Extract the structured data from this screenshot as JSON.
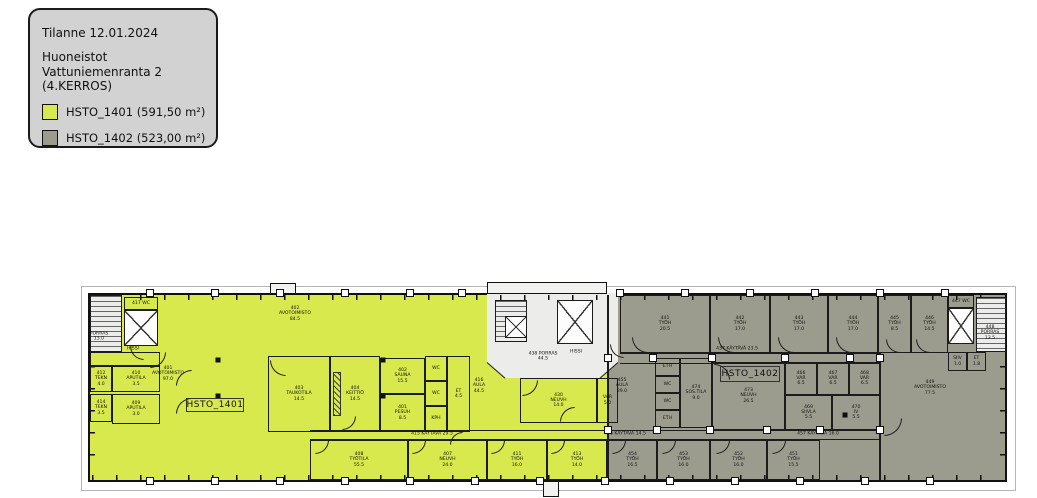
{
  "legend": {
    "status_line": "Tilanne 12.01.2024",
    "title_lines": [
      "Huoneistot",
      "Vattuniemenranta 2",
      "(4.KERROS)"
    ],
    "items": [
      {
        "id": "HSTO_1401",
        "label": "HSTO_1401 (591,50 m²)",
        "color": "#d7e94c"
      },
      {
        "id": "HSTO_1402",
        "label": "HSTO_1402 (523,00 m²)",
        "color": "#9c9c8e"
      }
    ]
  },
  "colors": {
    "apartment_1401": "#d7e94c",
    "apartment_1402": "#9c9c8e",
    "common_area": "#ececea",
    "wall": "#1c1c1c",
    "legend_bg": "#d2d2d2"
  },
  "plan": {
    "apartment_boxes": [
      {
        "text": "HSTO_1401",
        "x": 186,
        "y": 398,
        "w": 58,
        "h": 14
      },
      {
        "text": "HSTO_1402",
        "x": 720,
        "y": 366,
        "w": 60,
        "h": 16
      }
    ],
    "rooms": [
      {
        "x": 90,
        "y": 295,
        "w": 32,
        "h": 57,
        "fill": "stairs",
        "lines": []
      },
      {
        "x": 124,
        "y": 297,
        "w": 34,
        "h": 13,
        "fill": "yellow",
        "lines": [
          "417 WC"
        ]
      },
      {
        "x": 124,
        "y": 310,
        "w": 34,
        "h": 36,
        "fill": "elevator",
        "lines": []
      },
      {
        "x": 90,
        "y": 352,
        "w": 70,
        "h": 14,
        "fill": "yellow",
        "lines": []
      },
      {
        "x": 90,
        "y": 366,
        "w": 22,
        "h": 26,
        "fill": "yellow",
        "lines": [
          "412",
          "TEKN",
          "4.0"
        ]
      },
      {
        "x": 112,
        "y": 366,
        "w": 48,
        "h": 26,
        "fill": "yellow",
        "lines": [
          "410",
          "APUTILA",
          "3.5"
        ]
      },
      {
        "x": 90,
        "y": 394,
        "w": 22,
        "h": 28,
        "fill": "yellow",
        "lines": [
          "414",
          "TEKN",
          "3.5"
        ]
      },
      {
        "x": 112,
        "y": 394,
        "w": 48,
        "h": 30,
        "fill": "yellow",
        "lines": [
          "409",
          "APUTILA",
          "3.0"
        ]
      },
      {
        "x": 268,
        "y": 356,
        "w": 62,
        "h": 76,
        "fill": "yellow",
        "lines": [
          "403",
          "TAUKOTILA",
          "14.5"
        ]
      },
      {
        "x": 330,
        "y": 356,
        "w": 50,
        "h": 76,
        "fill": "yellow",
        "lines": [
          "404",
          "KEITTIÖ",
          "14.5"
        ]
      },
      {
        "x": 380,
        "y": 358,
        "w": 45,
        "h": 36,
        "fill": "yellow",
        "lines": [
          "402",
          "SAUNA",
          "15.5"
        ]
      },
      {
        "x": 380,
        "y": 394,
        "w": 45,
        "h": 38,
        "fill": "yellow",
        "lines": [
          "401",
          "PESUH",
          "8.5"
        ]
      },
      {
        "x": 425,
        "y": 356,
        "w": 22,
        "h": 25,
        "fill": "yellow",
        "lines": [
          "WC"
        ]
      },
      {
        "x": 425,
        "y": 381,
        "w": 22,
        "h": 25,
        "fill": "yellow",
        "lines": [
          "WC"
        ]
      },
      {
        "x": 425,
        "y": 406,
        "w": 22,
        "h": 26,
        "fill": "yellow",
        "lines": [
          "KPH"
        ]
      },
      {
        "x": 447,
        "y": 356,
        "w": 23,
        "h": 76,
        "fill": "yellow",
        "lines": [
          "ET",
          "4.5"
        ]
      },
      {
        "x": 520,
        "y": 378,
        "w": 77,
        "h": 45,
        "fill": "yellow",
        "lines": [
          "430",
          "NEUVH",
          "14.0"
        ]
      },
      {
        "x": 597,
        "y": 378,
        "w": 21,
        "h": 45,
        "fill": "gray",
        "lines": [
          "VAR",
          "5.0"
        ]
      },
      {
        "x": 310,
        "y": 440,
        "w": 98,
        "h": 40,
        "fill": "yellow",
        "lines": [
          "408",
          "TYÖTILA",
          "55.5"
        ]
      },
      {
        "x": 408,
        "y": 440,
        "w": 79,
        "h": 40,
        "fill": "yellow",
        "lines": [
          "407",
          "NEUVH",
          "24.0"
        ]
      },
      {
        "x": 487,
        "y": 440,
        "w": 60,
        "h": 40,
        "fill": "yellow",
        "lines": [
          "411",
          "TYÖH",
          "16.0"
        ]
      },
      {
        "x": 547,
        "y": 440,
        "w": 60,
        "h": 40,
        "fill": "yellow",
        "lines": [
          "413",
          "TYÖH",
          "14.0"
        ]
      },
      {
        "x": 620,
        "y": 295,
        "w": 90,
        "h": 58,
        "fill": "gray",
        "lines": [
          "441",
          "TYÖH",
          "20.5"
        ]
      },
      {
        "x": 710,
        "y": 295,
        "w": 60,
        "h": 58,
        "fill": "gray",
        "lines": [
          "442",
          "TYÖH",
          "17.0"
        ]
      },
      {
        "x": 770,
        "y": 295,
        "w": 58,
        "h": 58,
        "fill": "gray",
        "lines": [
          "443",
          "TYÖH",
          "17.0"
        ]
      },
      {
        "x": 828,
        "y": 295,
        "w": 50,
        "h": 58,
        "fill": "gray",
        "lines": [
          "444",
          "TYÖH",
          "17.0"
        ]
      },
      {
        "x": 878,
        "y": 295,
        "w": 33,
        "h": 58,
        "fill": "gray",
        "lines": [
          "445",
          "TYÖH",
          "8.5"
        ]
      },
      {
        "x": 911,
        "y": 295,
        "w": 37,
        "h": 58,
        "fill": "gray",
        "lines": [
          "446",
          "TYÖH",
          "14.5"
        ]
      },
      {
        "x": 948,
        "y": 295,
        "w": 26,
        "h": 13,
        "fill": "gray",
        "lines": [
          "447 WC"
        ]
      },
      {
        "x": 948,
        "y": 308,
        "w": 26,
        "h": 36,
        "fill": "elevator",
        "lines": []
      },
      {
        "x": 976,
        "y": 297,
        "w": 30,
        "h": 55,
        "fill": "stairs",
        "lines": []
      },
      {
        "x": 948,
        "y": 352,
        "w": 19,
        "h": 19,
        "fill": "gray",
        "lines": [
          "SIIV",
          "1.0"
        ]
      },
      {
        "x": 967,
        "y": 352,
        "w": 19,
        "h": 19,
        "fill": "gray",
        "lines": [
          "ET",
          "1.8"
        ]
      },
      {
        "x": 655,
        "y": 358,
        "w": 25,
        "h": 18,
        "fill": "gray",
        "lines": [
          "ETH"
        ]
      },
      {
        "x": 655,
        "y": 376,
        "w": 25,
        "h": 17,
        "fill": "gray",
        "lines": [
          "WC"
        ]
      },
      {
        "x": 655,
        "y": 393,
        "w": 25,
        "h": 17,
        "fill": "gray",
        "lines": [
          "WC"
        ]
      },
      {
        "x": 655,
        "y": 410,
        "w": 25,
        "h": 18,
        "fill": "gray",
        "lines": [
          "ETH"
        ]
      },
      {
        "x": 680,
        "y": 358,
        "w": 32,
        "h": 70,
        "fill": "gray",
        "lines": [
          "474",
          "SOS.TILA",
          "9.0"
        ]
      },
      {
        "x": 712,
        "y": 362,
        "w": 73,
        "h": 68,
        "fill": "gray",
        "lines": [
          "473",
          "NEUVH",
          "26.5"
        ]
      },
      {
        "x": 785,
        "y": 362,
        "w": 32,
        "h": 33,
        "fill": "gray",
        "lines": [
          "466",
          "VAR",
          "6.5"
        ]
      },
      {
        "x": 817,
        "y": 362,
        "w": 32,
        "h": 33,
        "fill": "gray",
        "lines": [
          "467",
          "VAR",
          "6.5"
        ]
      },
      {
        "x": 849,
        "y": 362,
        "w": 31,
        "h": 33,
        "fill": "gray",
        "lines": [
          "468",
          "VAR",
          "6.5"
        ]
      },
      {
        "x": 785,
        "y": 395,
        "w": 47,
        "h": 35,
        "fill": "gray",
        "lines": [
          "469",
          "SIIVLA",
          "5.5"
        ]
      },
      {
        "x": 832,
        "y": 395,
        "w": 48,
        "h": 35,
        "fill": "gray",
        "lines": [
          "470",
          "IV",
          "5.5"
        ]
      },
      {
        "x": 608,
        "y": 440,
        "w": 49,
        "h": 40,
        "fill": "gray",
        "lines": [
          "454",
          "TYÖH",
          "16.5"
        ]
      },
      {
        "x": 657,
        "y": 440,
        "w": 53,
        "h": 40,
        "fill": "gray",
        "lines": [
          "453",
          "TYÖH",
          "16.0"
        ]
      },
      {
        "x": 710,
        "y": 440,
        "w": 57,
        "h": 40,
        "fill": "gray",
        "lines": [
          "452",
          "TYÖH",
          "16.0"
        ]
      },
      {
        "x": 767,
        "y": 440,
        "w": 53,
        "h": 40,
        "fill": "gray",
        "lines": [
          "451",
          "TYÖH",
          "15.5"
        ]
      },
      {
        "x": 495,
        "y": 300,
        "w": 32,
        "h": 42,
        "fill": "stairs",
        "lines": []
      },
      {
        "x": 505,
        "y": 316,
        "w": 22,
        "h": 22,
        "fill": "elevator",
        "lines": []
      },
      {
        "x": 557,
        "y": 300,
        "w": 36,
        "h": 44,
        "fill": "elevator",
        "lines": []
      }
    ],
    "free_labels": [
      {
        "x": 168,
        "y": 374,
        "lines": [
          "401",
          "AVOTOIMISTO",
          "97.0"
        ]
      },
      {
        "x": 295,
        "y": 314,
        "lines": [
          "402",
          "AVOTOIMISTO",
          "84.5"
        ]
      },
      {
        "x": 432,
        "y": 434,
        "lines": [
          "415 KÄYTÄVÄ 29.5"
        ]
      },
      {
        "x": 479,
        "y": 386,
        "lines": [
          "416",
          "AULA",
          "44.5"
        ]
      },
      {
        "x": 99,
        "y": 337,
        "lines": [
          "PORRAS",
          "13.0"
        ]
      },
      {
        "x": 133,
        "y": 349,
        "lines": [
          "HISSI"
        ]
      },
      {
        "x": 543,
        "y": 357,
        "lines": [
          "438 PORRAS",
          "44.5"
        ]
      },
      {
        "x": 576,
        "y": 352,
        "lines": [
          "HISSI"
        ]
      },
      {
        "x": 737,
        "y": 349,
        "lines": [
          "437 KÄYTÄVÄ 23.5"
        ]
      },
      {
        "x": 622,
        "y": 386,
        "lines": [
          "455",
          "AULA",
          "29.0"
        ]
      },
      {
        "x": 930,
        "y": 388,
        "lines": [
          "449",
          "AVOTOIMISTO",
          "77.5"
        ]
      },
      {
        "x": 625,
        "y": 434,
        "lines": [
          "456 KÄYTÄVÄ 14.5"
        ]
      },
      {
        "x": 818,
        "y": 434,
        "lines": [
          "457 KÄYTÄVÄ 16.0"
        ]
      },
      {
        "x": 990,
        "y": 333,
        "lines": [
          "448",
          "PORRAS",
          "13.5"
        ]
      }
    ],
    "doors": [
      {
        "x": 150,
        "y": 352,
        "s": 16,
        "c": "br"
      },
      {
        "x": 130,
        "y": 346,
        "s": 14,
        "c": "bl"
      },
      {
        "x": 176,
        "y": 370,
        "s": 16,
        "c": "tl"
      },
      {
        "x": 176,
        "y": 398,
        "s": 16,
        "c": "tl"
      },
      {
        "x": 270,
        "y": 360,
        "s": 16,
        "c": "bl"
      },
      {
        "x": 342,
        "y": 416,
        "s": 14,
        "c": "br"
      },
      {
        "x": 450,
        "y": 432,
        "s": 13,
        "c": "tl"
      },
      {
        "x": 522,
        "y": 380,
        "s": 16,
        "c": "br"
      },
      {
        "x": 560,
        "y": 407,
        "s": 15,
        "c": "tl"
      },
      {
        "x": 315,
        "y": 440,
        "s": 14,
        "c": "br"
      },
      {
        "x": 412,
        "y": 440,
        "s": 14,
        "c": "br"
      },
      {
        "x": 491,
        "y": 440,
        "s": 14,
        "c": "br"
      },
      {
        "x": 551,
        "y": 440,
        "s": 14,
        "c": "br"
      },
      {
        "x": 632,
        "y": 337,
        "s": 16,
        "c": "bl"
      },
      {
        "x": 718,
        "y": 337,
        "s": 16,
        "c": "bl"
      },
      {
        "x": 778,
        "y": 337,
        "s": 16,
        "c": "bl"
      },
      {
        "x": 836,
        "y": 337,
        "s": 16,
        "c": "bl"
      },
      {
        "x": 886,
        "y": 339,
        "s": 14,
        "c": "bl"
      },
      {
        "x": 916,
        "y": 339,
        "s": 14,
        "c": "bl"
      },
      {
        "x": 612,
        "y": 440,
        "s": 14,
        "c": "br"
      },
      {
        "x": 662,
        "y": 440,
        "s": 14,
        "c": "br"
      },
      {
        "x": 716,
        "y": 440,
        "s": 14,
        "c": "br"
      },
      {
        "x": 772,
        "y": 440,
        "s": 14,
        "c": "br"
      },
      {
        "x": 714,
        "y": 364,
        "s": 16,
        "c": "tr"
      },
      {
        "x": 884,
        "y": 418,
        "s": 18,
        "c": "br"
      },
      {
        "x": 610,
        "y": 344,
        "s": 14,
        "c": "bl"
      }
    ],
    "columns_top": [
      150,
      215,
      280,
      345,
      410,
      462,
      620,
      685,
      750,
      815,
      880,
      945
    ],
    "columns_bottom": [
      150,
      215,
      280,
      345,
      410,
      475,
      540,
      605,
      670,
      735,
      800,
      865,
      930
    ],
    "columns_mid_upper": [
      608,
      653,
      712,
      785,
      850,
      880
    ],
    "columns_mid_lower": [
      608,
      657,
      710,
      767,
      820,
      880
    ],
    "black_dots": [
      [
        218,
        360
      ],
      [
        383,
        360
      ],
      [
        218,
        396
      ],
      [
        383,
        396
      ],
      [
        845,
        415
      ]
    ]
  }
}
